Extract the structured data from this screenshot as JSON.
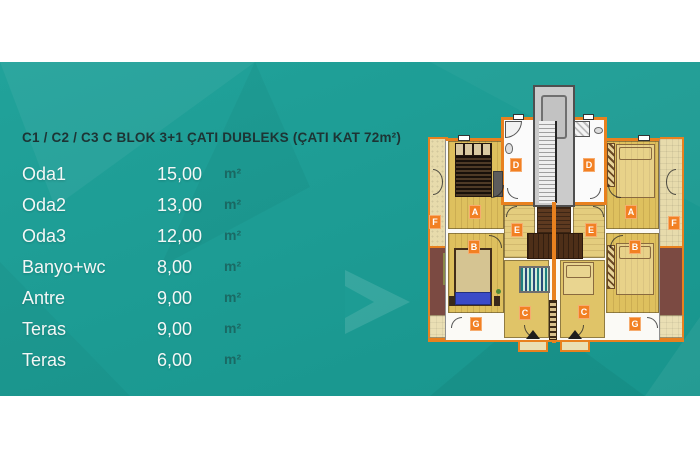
{
  "page": {
    "background_teal": "#1D9C94",
    "wall_orange": "#E8811F",
    "label_orange": "#F28023"
  },
  "panel": {
    "title": "C1 / C2 / C3 C BLOK 3+1 ÇATI DUBLEKS (ÇATI KAT 72m²)",
    "rows": [
      {
        "name": "Oda1",
        "value": "15,00",
        "unit": "m²"
      },
      {
        "name": "Oda2",
        "value": "13,00",
        "unit": "m²"
      },
      {
        "name": "Oda3",
        "value": "12,00",
        "unit": "m²"
      },
      {
        "name": "Banyo+wc",
        "value": "8,00",
        "unit": "m²"
      },
      {
        "name": "Antre",
        "value": "9,00",
        "unit": "m²"
      },
      {
        "name": "Teras",
        "value": "9,00",
        "unit": "m²"
      },
      {
        "name": "Teras",
        "value": "6,00",
        "unit": "m²"
      }
    ]
  },
  "plan": {
    "labels": {
      "d_left": "D",
      "d_right": "D",
      "a_left": "A",
      "a_right": "A",
      "e_left": "E",
      "e_right": "E",
      "b_left": "B",
      "b_right": "B",
      "c_left": "C",
      "c_right": "C",
      "f_left": "F",
      "f_right": "F",
      "g_left": "G",
      "g_right": "G"
    }
  }
}
